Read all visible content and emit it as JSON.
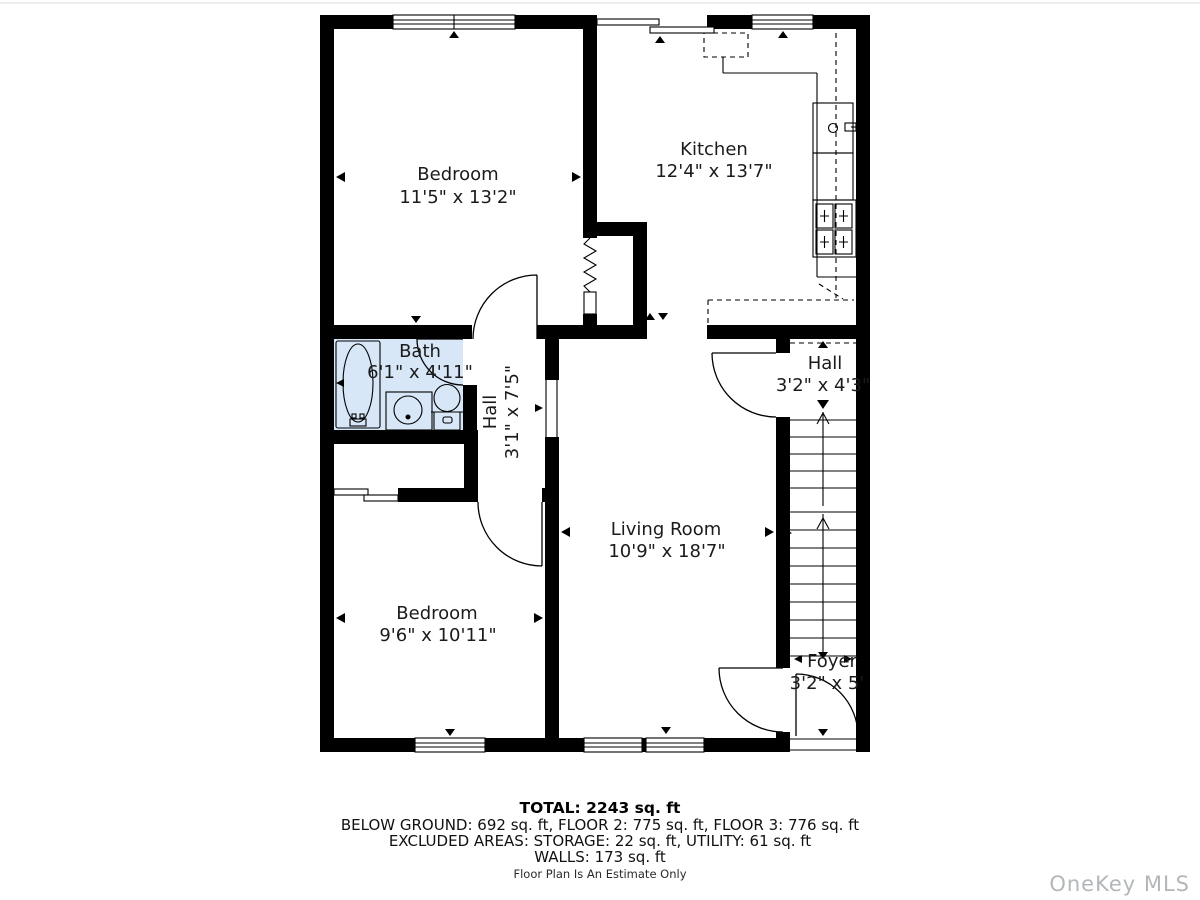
{
  "rooms": {
    "bedroom1": {
      "name": "Bedroom",
      "dims": "11'5\" x 13'2\""
    },
    "kitchen": {
      "name": "Kitchen",
      "dims": "12'4\" x 13'7\""
    },
    "bath": {
      "name": "Bath",
      "dims": "6'1\" x 4'11\""
    },
    "hall_center": {
      "name": "Hall",
      "dims": "3'1\" x 7'5\""
    },
    "hall_right": {
      "name": "Hall",
      "dims": "3'2\" x 4'3\""
    },
    "living": {
      "name": "Living Room",
      "dims": "10'9\" x 18'7\""
    },
    "bedroom2": {
      "name": "Bedroom",
      "dims": "9'6\" x 10'11\""
    },
    "foyer": {
      "name": "Foyer",
      "dims": "3'2\" x 5'"
    }
  },
  "summary": {
    "total": "TOTAL: 2243 sq. ft",
    "floors": "BELOW GROUND: 692 sq. ft, FLOOR 2: 775 sq. ft, FLOOR 3: 776 sq. ft",
    "excluded": "EXCLUDED AREAS: STORAGE: 22 sq. ft, UTILITY: 61 sq. ft",
    "walls": "WALLS: 173 sq. ft",
    "disclaimer": "Floor Plan Is An Estimate Only"
  },
  "watermark": "OneKey MLS",
  "colors": {
    "wall": "#000000",
    "bath_fill": "#d7e7f7",
    "text": "#1b1b1b",
    "watermark": "#b3b7b9"
  }
}
